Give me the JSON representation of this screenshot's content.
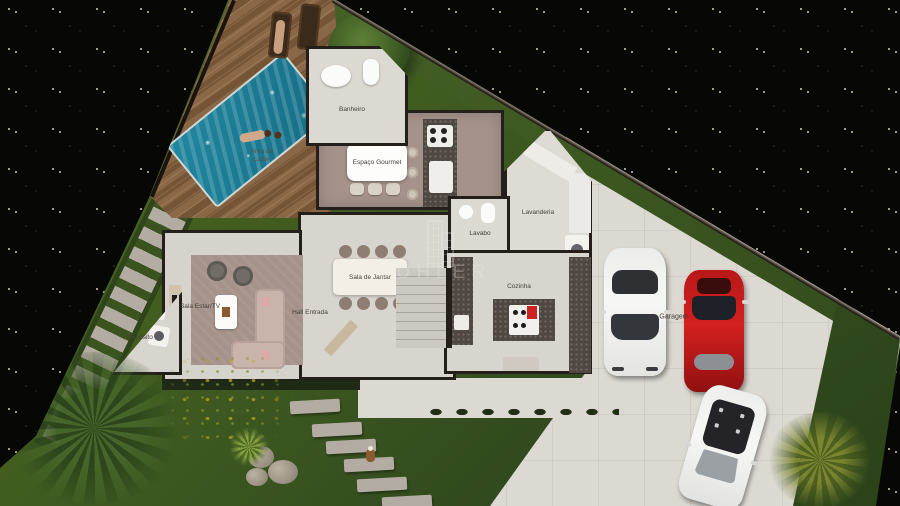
{
  "brand": {
    "watermark": "BÜHLER"
  },
  "labels": {
    "banheiro": "Banheiro",
    "espaco_gourmet": "Espaço Gourmet",
    "lavabo": "Lavabo",
    "lavanderia": "Lavanderia",
    "sala_de_jantar": "Sala de Jantar",
    "cozinha": "Cozinha",
    "sala_estar_tv": "Sala Estar/TV",
    "hall_entrada": "Hall Entrada",
    "deposito": "Depósito",
    "garagem": "Garagem",
    "area_de_lazer": "Área de Lazer"
  },
  "colors": {
    "bg-black": "#070706",
    "grass": "#3f5824",
    "deck-wood": "#8a6746",
    "deck-wood-dark": "#755536",
    "pool-water": "#2187a0",
    "pool-water-deep": "#156d85",
    "concrete": "#dcd9d3",
    "floor-light": "#d8d5cf",
    "floor-mauve": "#a5928a",
    "wall": "#241f1a",
    "granite": "#4e4742",
    "car-red": "#d42020",
    "car-white": "#f7f7f5",
    "accent-red": "#cc2222",
    "stone-step": "#b3aca3"
  }
}
